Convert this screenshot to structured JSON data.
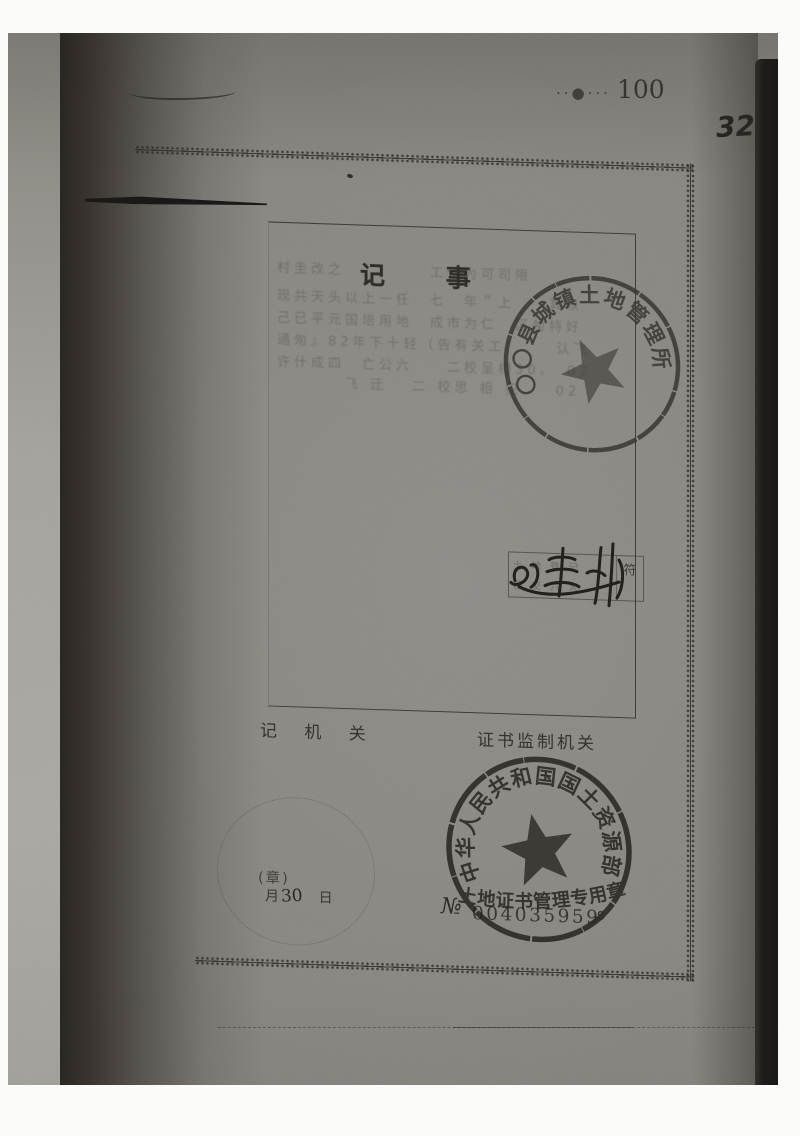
{
  "page": {
    "page_number_dots": "··●···",
    "page_number": "100",
    "handwritten_number": "32"
  },
  "record": {
    "title": "记  事",
    "faded_lines": [
      "村圭改之　　　　　工任为可司限",
      "现共天头以上一任　七　年＂上　　其以",
      "己已平元国培用地　成市为仁　区匆特好",
      "通匆』82年下十轻〔告有关工　　　认飞",
      "许什成四　亡公六　　二校呈相30。　02",
      "　　　　飞 迂　 二 校思 相 犯　　02"
    ]
  },
  "upper_stamp": {
    "ring_text": "〇〇县城镇土地管理所"
  },
  "middle": {
    "box_row1": "土 地 登 记",
    "box_row2": "移 交 六 大",
    "box_tag": "符",
    "signature_text": "刘志刚"
  },
  "footer_labels": {
    "left": "记 机 关",
    "right": "证书监制机关"
  },
  "date_stamp": {
    "seal_note": "(章)",
    "month_char": "月",
    "day_value": "30",
    "day_char": "日"
  },
  "ministry_stamp": {
    "ring_text": "中华人民共和国国土资源部",
    "title_text": "土地证书管理专用章",
    "serial_prefix": "№",
    "serial_number": "004035959",
    "serial_suffix": "s"
  }
}
